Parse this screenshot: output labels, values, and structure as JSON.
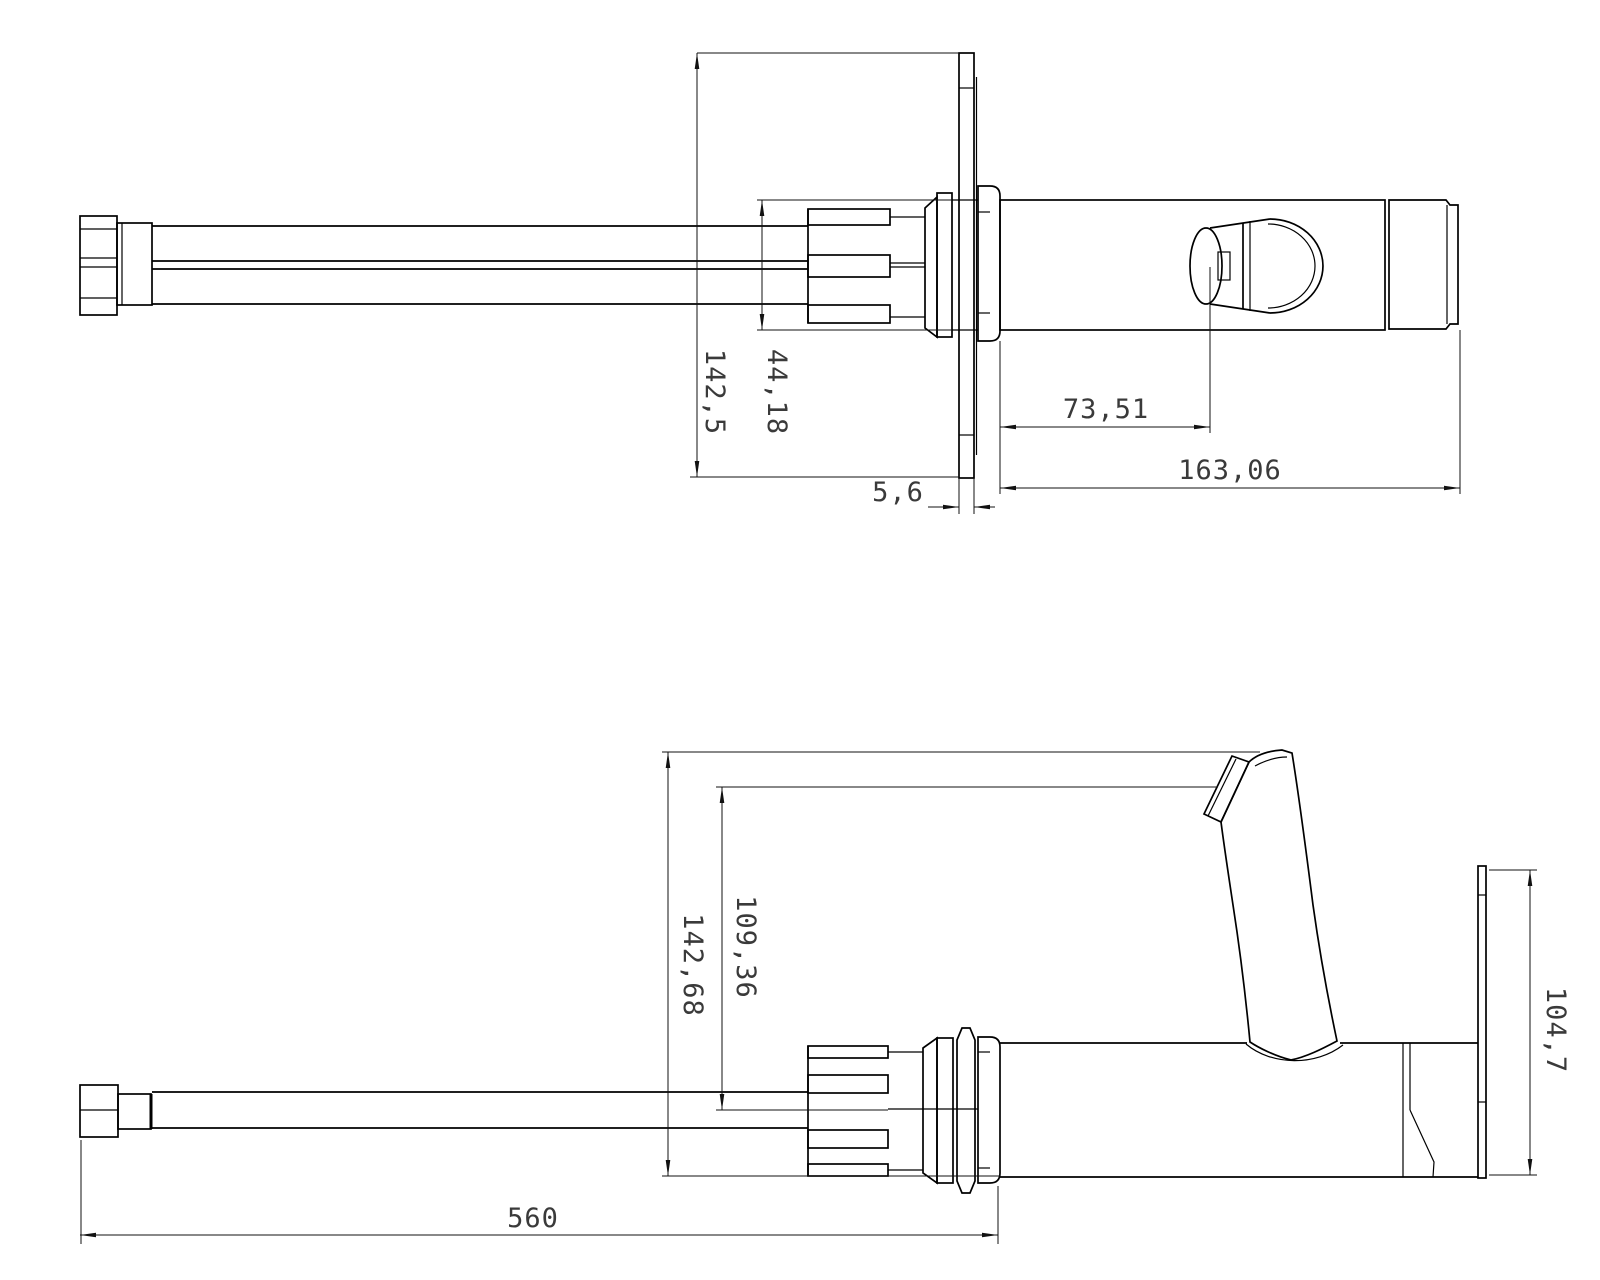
{
  "page": {
    "background": "#ffffff",
    "line_color": "#000000",
    "dim_text_color": "#3a3a3a"
  },
  "views": {
    "top": {
      "name": "top-view",
      "dimensions": {
        "overall_height": "142,5",
        "cartridge_height": "44,18",
        "plate_thickness": "5,6",
        "knob_offset": "73,51",
        "body_length": "163,06"
      }
    },
    "side": {
      "name": "side-view",
      "dimensions": {
        "overall_height": "142,68",
        "hose_axis_height": "109,36",
        "hose_length": "560",
        "plate_height": "104,7"
      }
    }
  }
}
